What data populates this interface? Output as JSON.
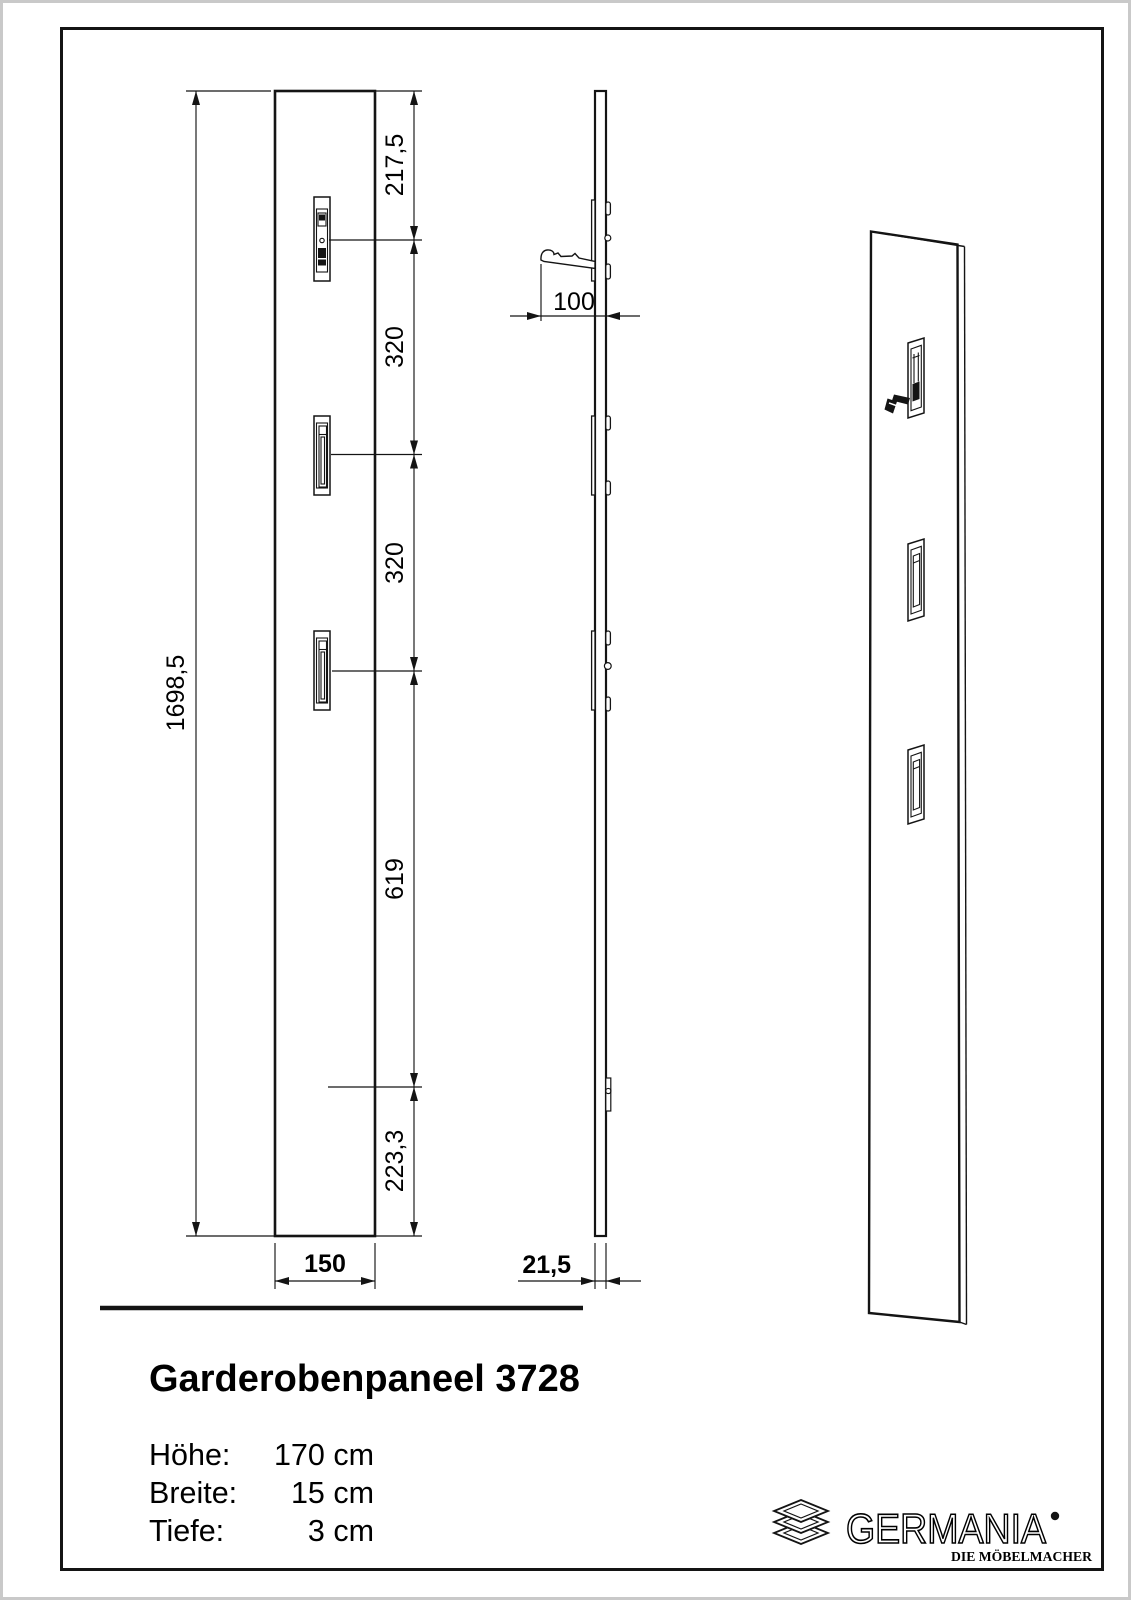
{
  "drawing": {
    "front_view": {
      "height_label": "1698,5",
      "width_label": "150",
      "segments": [
        "217,5",
        "320",
        "320",
        "619",
        "223,3"
      ]
    },
    "side_view": {
      "hook_depth_label": "100",
      "panel_depth_label": "21,5"
    }
  },
  "product": {
    "title": "Garderobenpaneel 3728",
    "specs": [
      {
        "label": "Höhe:",
        "value": "170 cm"
      },
      {
        "label": "Breite:",
        "value": "15 cm"
      },
      {
        "label": "Tiefe:",
        "value": "3 cm"
      }
    ]
  },
  "logo": {
    "brand": "GERMANIA",
    "tagline": "DIE MÖBELMACHER"
  },
  "colors": {
    "line": "#141414",
    "paper": "#ffffff",
    "page_edge": "#c9c9c9"
  }
}
